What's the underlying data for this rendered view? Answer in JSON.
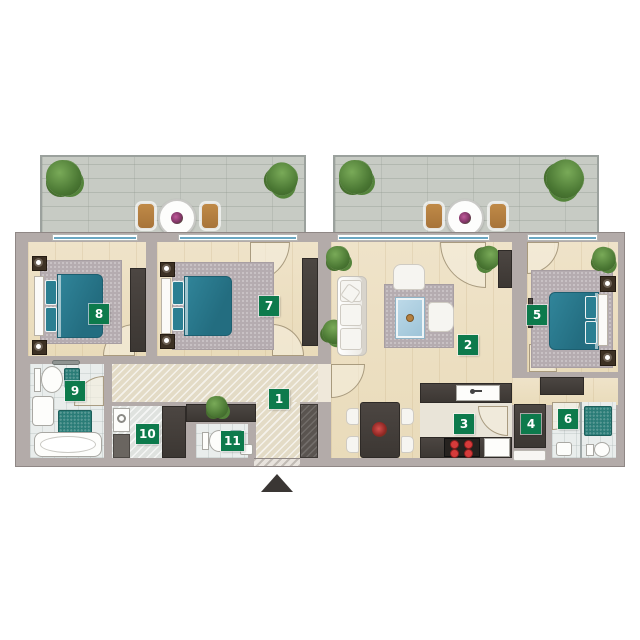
{
  "plan": {
    "room_labels": [
      {
        "number": "1"
      },
      {
        "number": "2"
      },
      {
        "number": "3"
      },
      {
        "number": "4"
      },
      {
        "number": "5"
      },
      {
        "number": "6"
      },
      {
        "number": "7"
      },
      {
        "number": "8"
      },
      {
        "number": "9"
      },
      {
        "number": "10"
      },
      {
        "number": "11"
      }
    ]
  },
  "colors": {
    "label_bg": "#0d7a4c",
    "label_text": "#ffffff",
    "bed": "#2b7f92",
    "wall": "#b3aba9",
    "wood_floor": "#ecdfc2",
    "tile_floor": "#e9edec",
    "balcony_floor": "#c7cbc4",
    "dark_furniture": "#46403d",
    "hob_red": "#d63b3b",
    "wood_furniture": "#b5803f",
    "plant_green": "#55813c",
    "rug": "#b5acb0",
    "water_blue": "#a9cede"
  }
}
